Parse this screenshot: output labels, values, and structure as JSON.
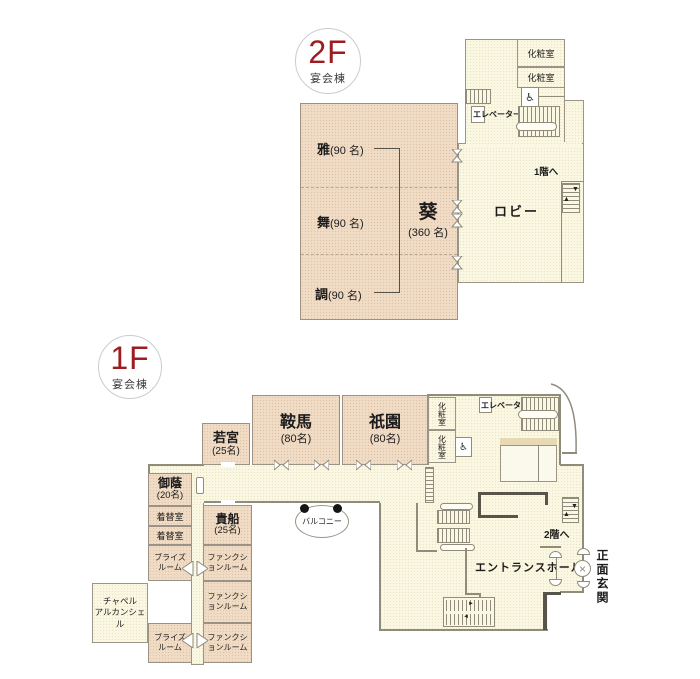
{
  "floor2": {
    "badge": {
      "level": "2F",
      "building": "宴会棟"
    },
    "rooms": {
      "miyabi": {
        "name": "雅",
        "capacity": "(90 名)"
      },
      "mai": {
        "name": "舞",
        "capacity": "(90 名)"
      },
      "shirabe": {
        "name": "調",
        "capacity": "(90 名)"
      },
      "aoi": {
        "name": "葵",
        "capacity": "(360 名)"
      }
    },
    "labels": {
      "lobby": "ロビー",
      "powder_room_1": "化粧室",
      "powder_room_2": "化粧室",
      "elevator": "エレベーター",
      "to_floor1": "1階へ"
    }
  },
  "floor1": {
    "badge": {
      "level": "1F",
      "building": "宴会棟"
    },
    "rooms": {
      "wakamiya": {
        "name": "若宮",
        "capacity": "(25名)"
      },
      "kurama": {
        "name": "鞍馬",
        "capacity": "(80名)"
      },
      "gion": {
        "name": "祇園",
        "capacity": "(80名)"
      },
      "mikage": {
        "name": "御蔭",
        "capacity": "(20名)"
      },
      "kifune": {
        "name": "貴船",
        "capacity": "(25名)"
      },
      "dressing_room_1": "着替室",
      "dressing_room_2": "着替室",
      "brides_room_1": "ブライズルーム",
      "brides_room_2": "ブライズルーム",
      "function_room_1": "ファンクションルーム",
      "function_room_2": "ファンクションルーム",
      "function_room_3": "ファンクションルーム",
      "chapel": {
        "line1": "チャペル",
        "line2": "アルカンシェル"
      }
    },
    "labels": {
      "balcony": "バルコニー",
      "powder_room_1": "化粧室",
      "powder_room_2": "化粧室",
      "elevator": "エレベーター",
      "to_floor2": "2階へ",
      "entrance_hall": "エントランスホール",
      "main_entrance": "正面玄関"
    }
  },
  "icons": {
    "wheelchair": "♿",
    "arrow_up": "▲",
    "arrow_down": "▼",
    "arrow_left": "◄",
    "arrow_right": "►",
    "cross": "×"
  },
  "colors": {
    "room_fill": "#f0dcc6",
    "corridor_fill": "#faf7e3",
    "accent_red": "#9d1c21",
    "wall": "#8f8c7c"
  }
}
